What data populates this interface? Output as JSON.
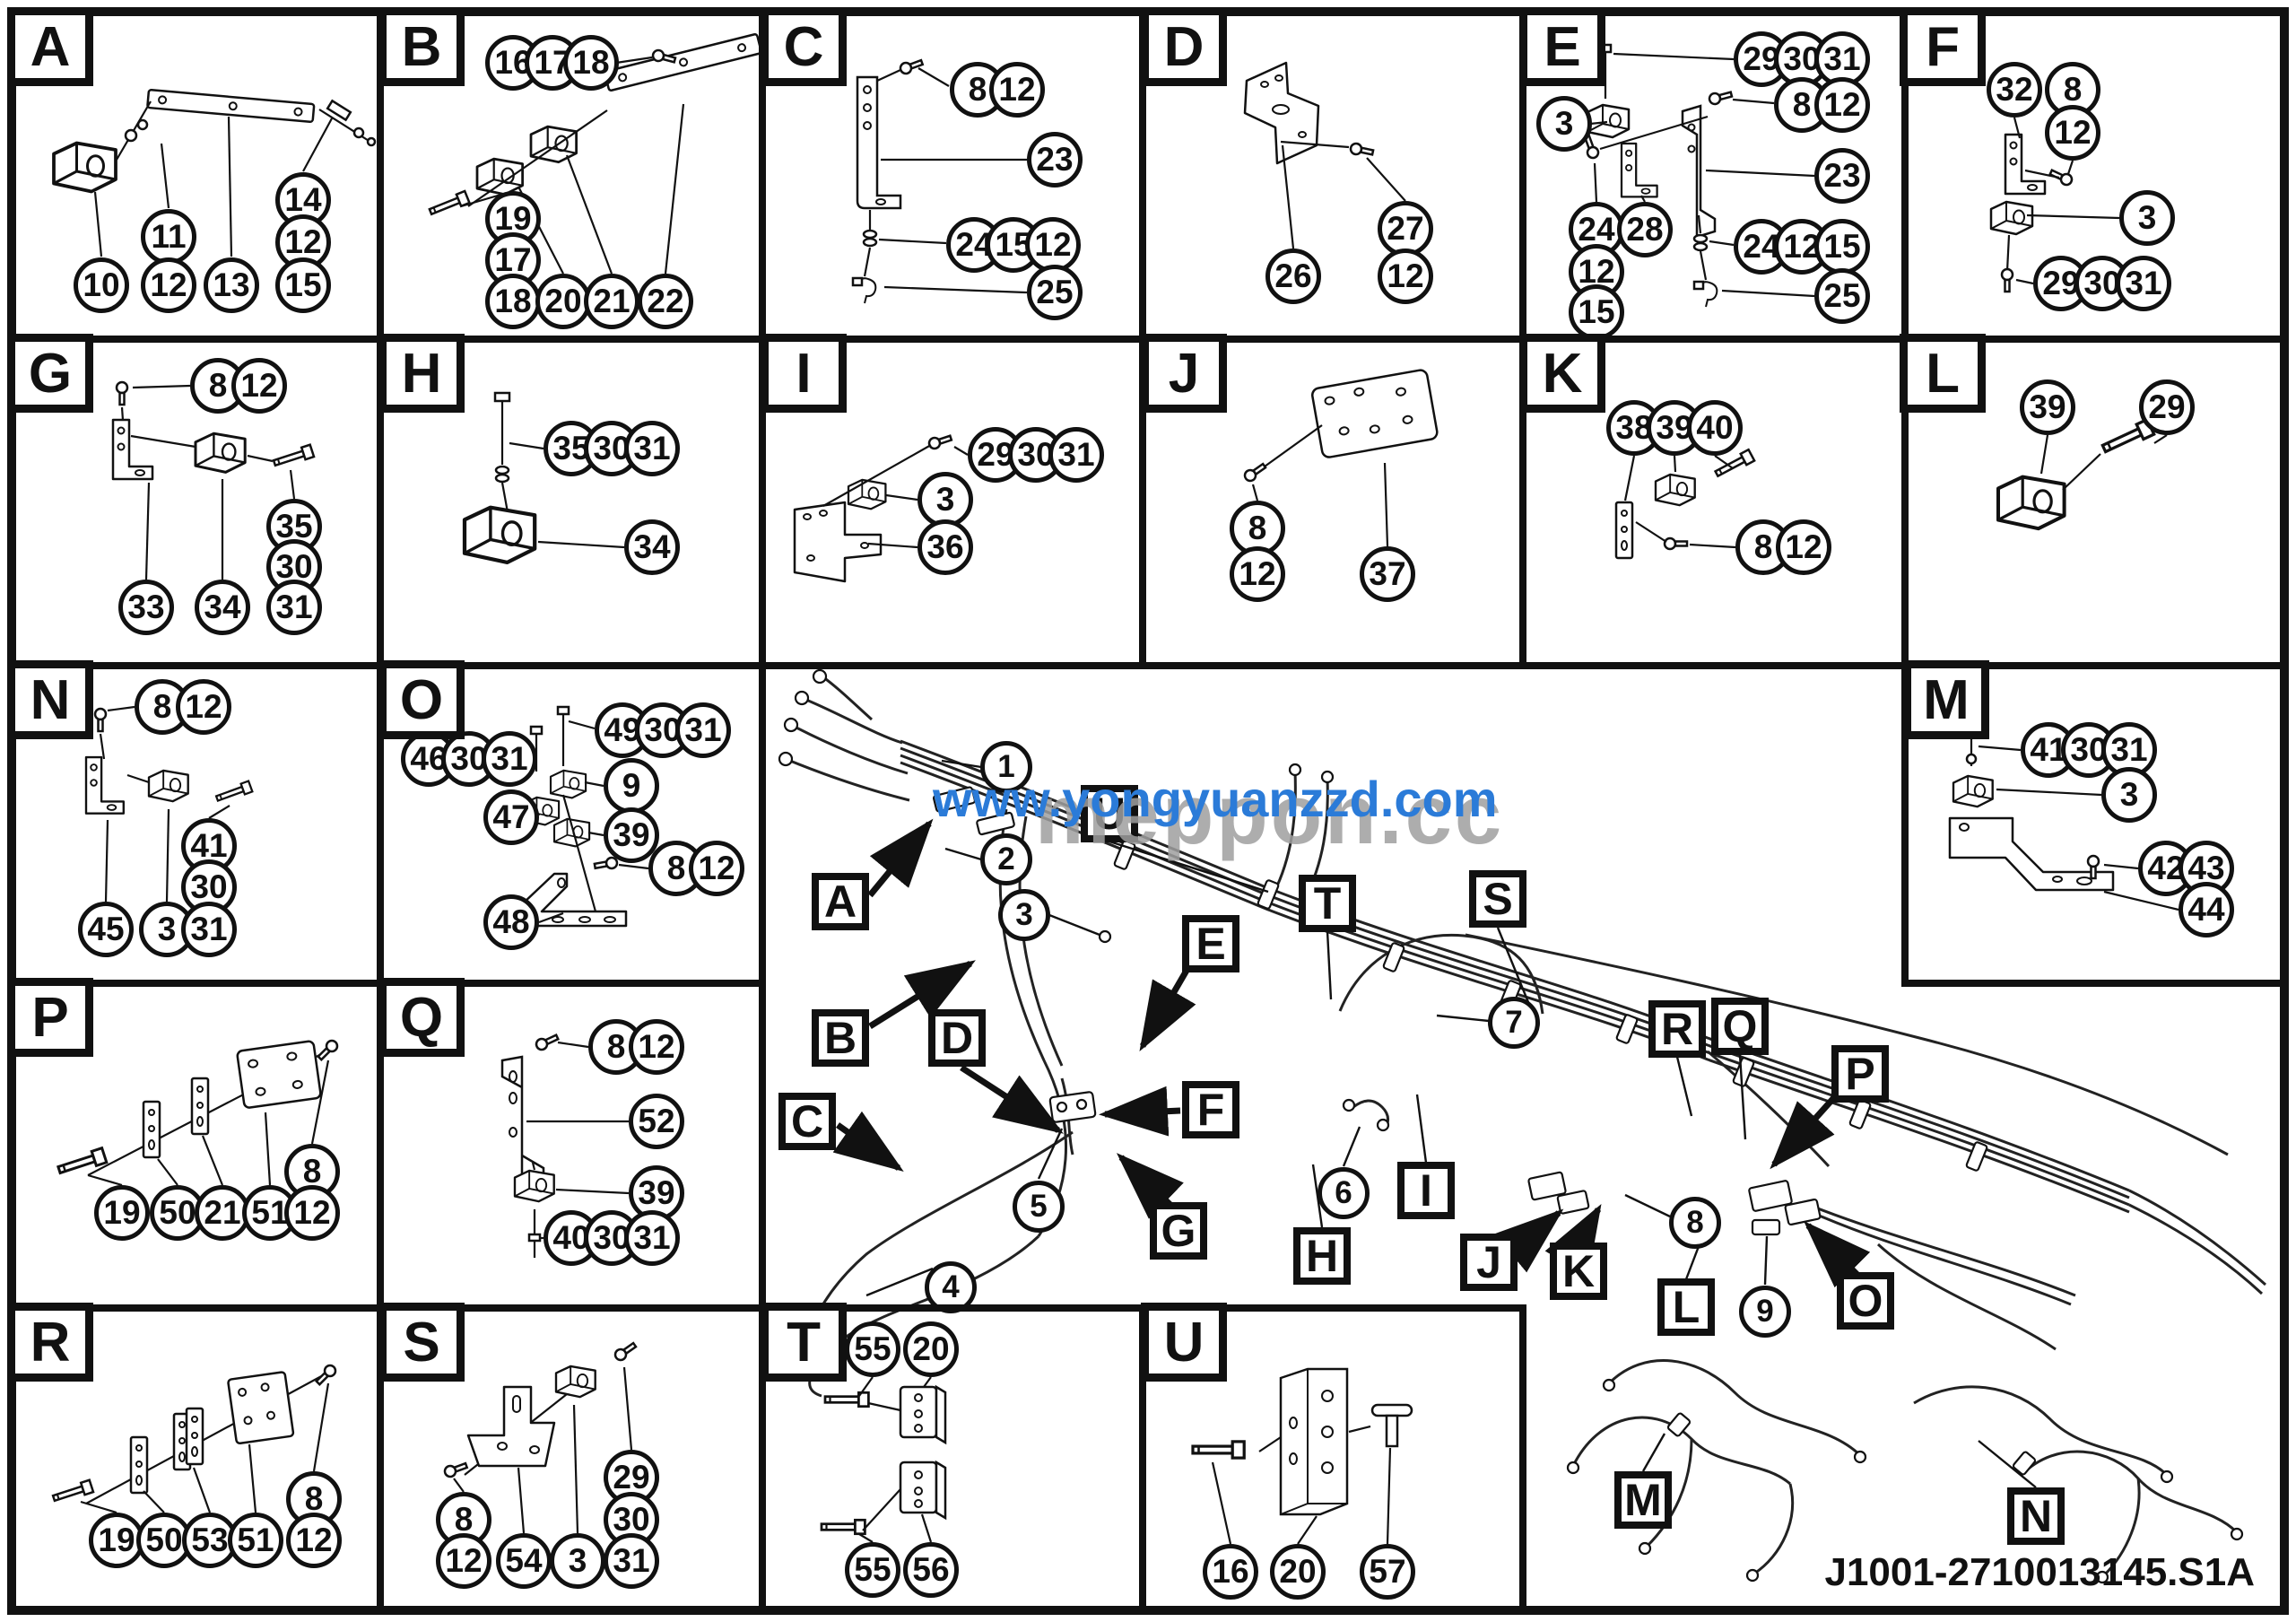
{
  "watermark": {
    "overlay": "www.yongyuanzzd.com",
    "underlay": "meppon.cc"
  },
  "drawing_number": "J1001-2710013145.S1A",
  "panels": {
    "A": {
      "label": "A",
      "callouts": [
        "10",
        "11",
        "12",
        "13",
        "14",
        "12",
        "15"
      ]
    },
    "B": {
      "label": "B",
      "callouts": [
        "16",
        "17",
        "18",
        "19",
        "17",
        "18",
        "20",
        "21",
        "22"
      ]
    },
    "C": {
      "label": "C",
      "callouts": [
        "8",
        "12",
        "23",
        "24",
        "15",
        "12",
        "25"
      ]
    },
    "D": {
      "label": "D",
      "callouts": [
        "26",
        "27",
        "12"
      ]
    },
    "E": {
      "label": "E",
      "callouts": [
        "29",
        "30",
        "31",
        "8",
        "12",
        "3",
        "23",
        "24",
        "28",
        "12",
        "15",
        "24",
        "12",
        "15",
        "25"
      ]
    },
    "F": {
      "label": "F",
      "callouts": [
        "32",
        "8",
        "12",
        "3",
        "29",
        "30",
        "31"
      ]
    },
    "G": {
      "label": "G",
      "callouts": [
        "8",
        "12",
        "33",
        "34",
        "35",
        "30",
        "31"
      ]
    },
    "H": {
      "label": "H",
      "callouts": [
        "35",
        "30",
        "31",
        "34"
      ]
    },
    "I": {
      "label": "I",
      "callouts": [
        "29",
        "30",
        "31",
        "3",
        "36"
      ]
    },
    "J": {
      "label": "J",
      "callouts": [
        "8",
        "12",
        "37"
      ]
    },
    "K": {
      "label": "K",
      "callouts": [
        "38",
        "39",
        "40",
        "8",
        "12"
      ]
    },
    "L": {
      "label": "L",
      "callouts": [
        "39",
        "29"
      ]
    },
    "M": {
      "label": "M",
      "callouts": [
        "41",
        "30",
        "31",
        "3",
        "42",
        "43",
        "44"
      ]
    },
    "N": {
      "label": "N",
      "callouts": [
        "8",
        "12",
        "45",
        "3",
        "41",
        "30",
        "31"
      ]
    },
    "O": {
      "label": "O",
      "callouts": [
        "49",
        "30",
        "31",
        "46",
        "30",
        "31",
        "9",
        "47",
        "39",
        "8",
        "12",
        "48"
      ]
    },
    "P": {
      "label": "P",
      "callouts": [
        "19",
        "50",
        "21",
        "51",
        "8",
        "12"
      ]
    },
    "Q": {
      "label": "Q",
      "callouts": [
        "8",
        "12",
        "52",
        "39",
        "40",
        "30",
        "31"
      ]
    },
    "R": {
      "label": "R",
      "callouts": [
        "19",
        "50",
        "53",
        "51",
        "8",
        "12"
      ]
    },
    "S": {
      "label": "S",
      "callouts": [
        "8",
        "12",
        "54",
        "3",
        "29",
        "30",
        "31"
      ]
    },
    "T": {
      "label": "T",
      "callouts": [
        "55",
        "20",
        "55",
        "56"
      ]
    },
    "U": {
      "label": "U",
      "callouts": [
        "16",
        "20",
        "57"
      ]
    }
  },
  "central": {
    "labels": [
      "A",
      "B",
      "C",
      "D",
      "E",
      "F",
      "G",
      "H",
      "I",
      "J",
      "K",
      "L",
      "M",
      "N",
      "O",
      "P",
      "Q",
      "R",
      "S",
      "T",
      "U"
    ],
    "callouts": [
      "1",
      "2",
      "3",
      "4",
      "5",
      "6",
      "7",
      "8",
      "9"
    ]
  }
}
